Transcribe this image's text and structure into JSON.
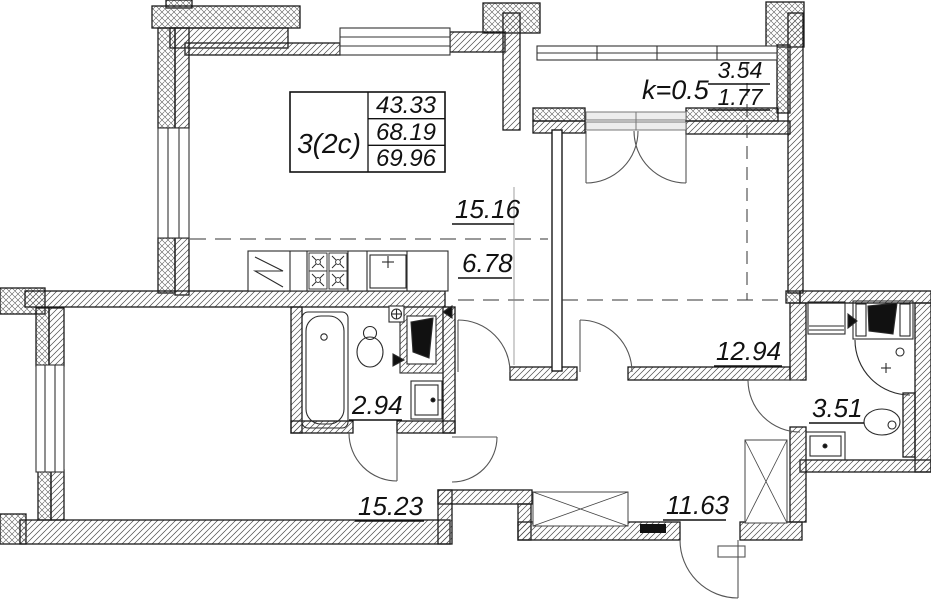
{
  "plan": {
    "title_block": {
      "unit_label": "3(2c)",
      "living_area": "43.33",
      "area_without_balcony": "68.19",
      "total_area": "69.96"
    },
    "balcony": {
      "coefficient": "k=0.5",
      "area_full": "3.54",
      "area_reduced": "1.77"
    },
    "rooms": {
      "kitchen_living_area": "15.16",
      "kitchen_zone_area": "6.78",
      "bedroom_area": "12.94",
      "bathroom_area": "2.94",
      "shower_room_area": "3.51",
      "living_room_area": "15.23",
      "hallway_area": "11.63"
    }
  }
}
